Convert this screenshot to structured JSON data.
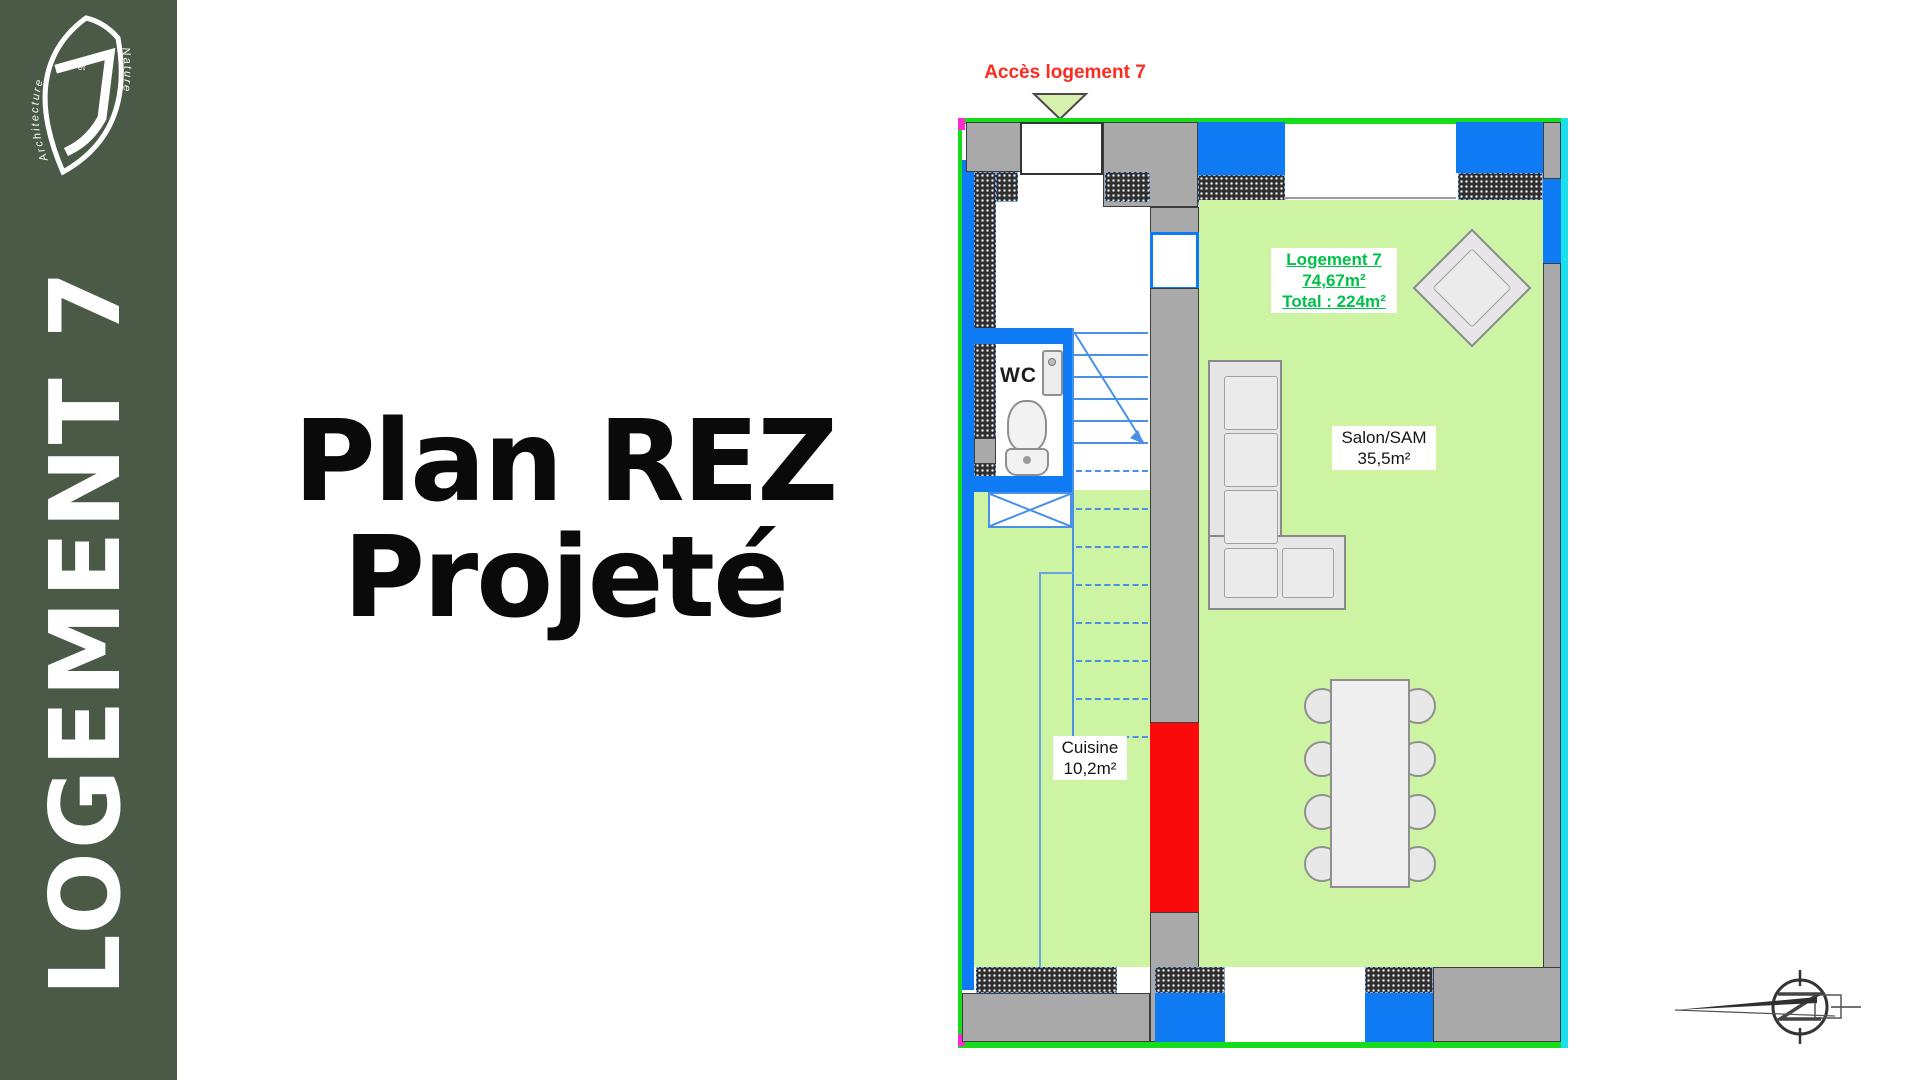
{
  "sidebar": {
    "title": "LOGEMENT 7",
    "logo": {
      "word1": "Architecture",
      "word2": "et",
      "word3": "Nature"
    }
  },
  "title": {
    "line1": "Plan REZ",
    "line2": "Projeté"
  },
  "plan": {
    "access_label": "Accès logement 7",
    "unit_label": {
      "line1": "Logement 7",
      "line2": "74,67m²",
      "line3": "Total : 224m²"
    },
    "rooms": {
      "salon": {
        "name": "Salon/SAM",
        "area": "35,5m²"
      },
      "cuisine": {
        "name": "Cuisine",
        "area": "10,2m²"
      },
      "wc": {
        "name": "WC"
      }
    },
    "colors": {
      "sidebar_green": "#4a5a47",
      "boundary_green": "#16dd1c",
      "boundary_cyan": "#1ae0ee",
      "window_blue": "#0e7bf4",
      "stair_blue": "#4a90e8",
      "floor_green": "#ccf4a3",
      "wall_gray": "#a9a9a9",
      "highlight_red": "#fa0a0a",
      "unit_label_green": "#00c24a",
      "access_red": "#fb2b20",
      "corner_magenta": "#ff2ad4"
    }
  }
}
